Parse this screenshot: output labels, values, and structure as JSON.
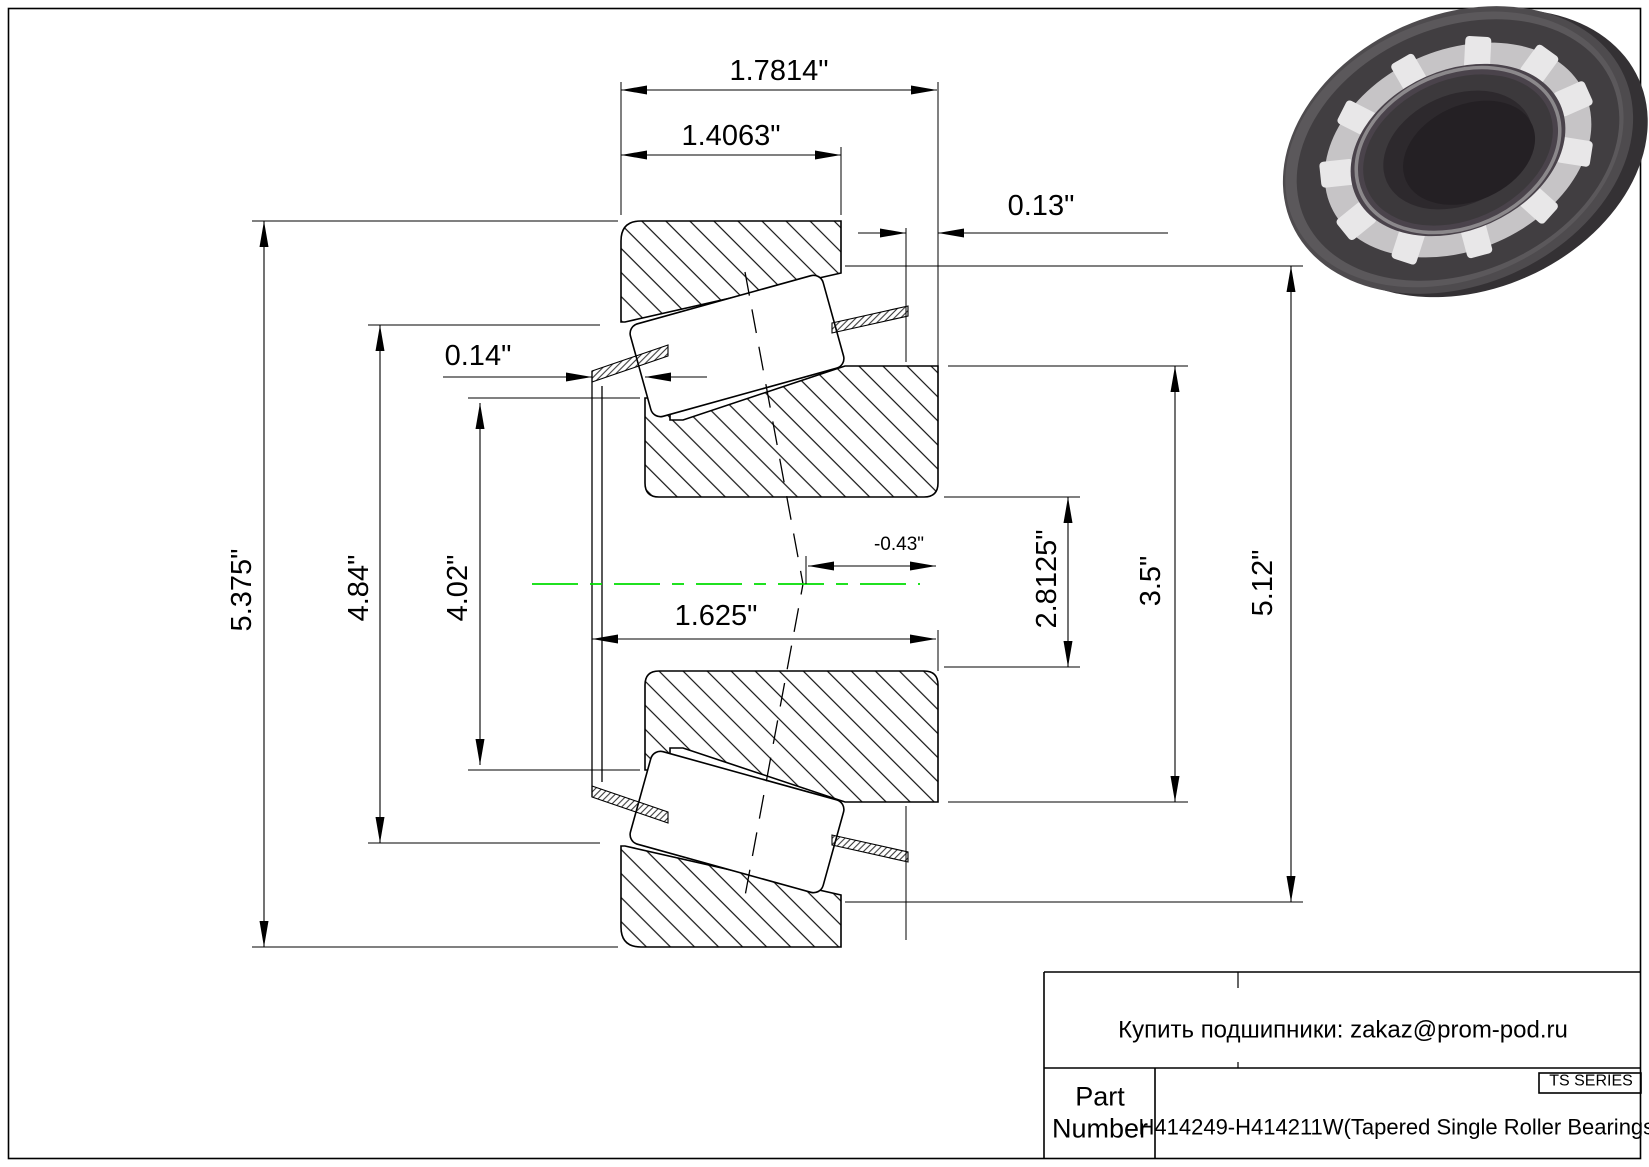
{
  "drawing": {
    "centerline_color": "#00dd00",
    "dims": {
      "overall_width": "1.7814\"",
      "cup_width": "1.4063\"",
      "cup_standout": "0.13\"",
      "cage_standout": "0.14\"",
      "cup_od": "5.375\"",
      "cage_od": "4.84\"",
      "cone_front_od": "4.02\"",
      "effective_center": "-0.43\"",
      "inner_width": "1.625\"",
      "bore_dia": "2.8125\"",
      "cone_od": "3.5\"",
      "outer_ref_dia": "5.12\""
    }
  },
  "title_block": {
    "contact": "Купить подшипники: zakaz@prom-pod.ru",
    "series": "TS SERIES",
    "part_label": "Part\nNumber",
    "part_value": "H414249-H414211W(Tapered Single Roller Bearings)"
  },
  "illustration": {
    "alt": "tapered-roller-bearing-3d-render"
  }
}
